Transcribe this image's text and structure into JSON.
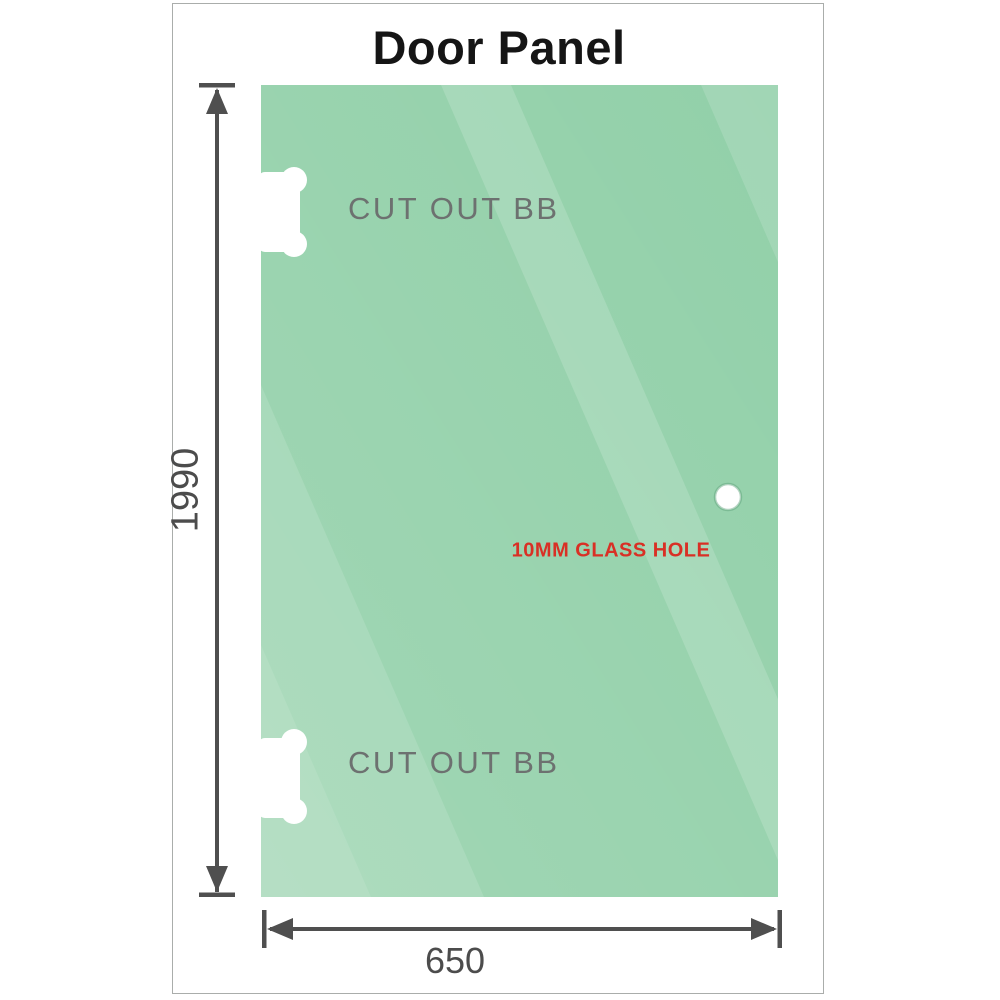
{
  "title": "Door Panel",
  "panel": {
    "cutout_top": {
      "label": "CUT OUT BB"
    },
    "cutout_bottom": {
      "label": "CUT OUT BB"
    },
    "glass_hole": {
      "label": "10MM GLASS HOLE"
    }
  },
  "dimensions": {
    "height": {
      "label": "1990"
    },
    "width": {
      "label": "650"
    }
  },
  "colors": {
    "glass_green": "#92d0a9",
    "dimension_gray": "#4f4f4f",
    "cutout_label_gray": "#6d7170",
    "hole_label_red": "#d93025",
    "frame_border": "#aaadab",
    "title_black": "#151515"
  }
}
